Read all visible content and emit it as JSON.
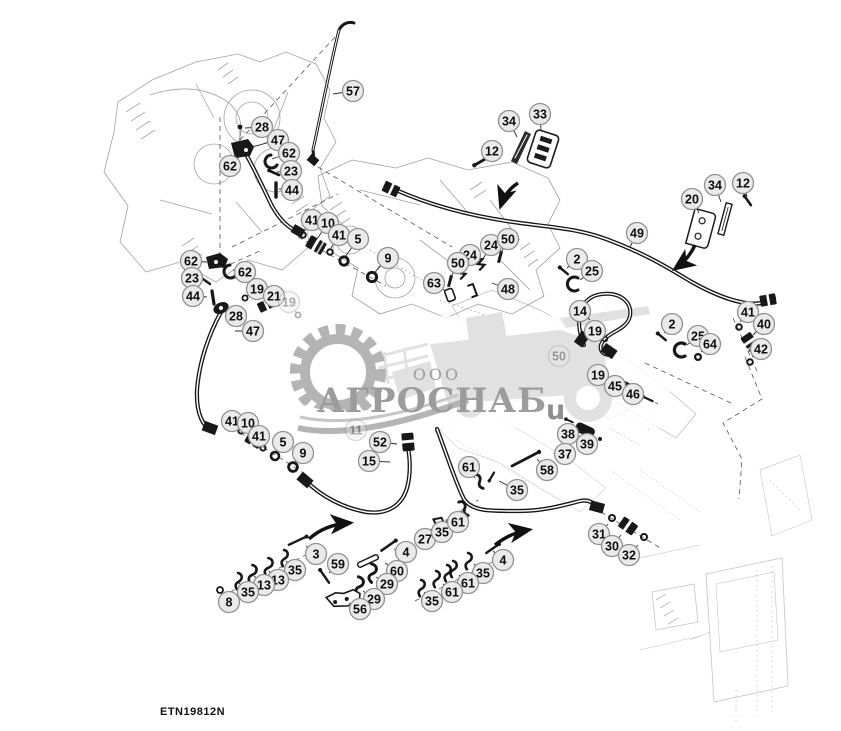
{
  "page": {
    "part_number": "ETN19812N"
  },
  "watermark": {
    "company_prefix": "ООО",
    "company": "АГРОСНАБ",
    "suffix": "u",
    "color": "#9c9c9c"
  },
  "callouts": {
    "style": {
      "radius": 10.5,
      "fill": "#eaeaea",
      "stroke": "#8f8f8f",
      "text_color": "#0d0d0d"
    },
    "labels": [
      {
        "n": "57",
        "x": 353,
        "y": 91,
        "tx": 333,
        "ty": 94
      },
      {
        "n": "28",
        "x": 262,
        "y": 127,
        "tx": 245,
        "ty": 128
      },
      {
        "n": "47",
        "x": 278,
        "y": 140,
        "tx": 252,
        "ty": 147
      },
      {
        "n": "62",
        "x": 289,
        "y": 153,
        "tx": 272,
        "ty": 159
      },
      {
        "n": "23",
        "x": 291,
        "y": 171,
        "tx": 277,
        "ty": 172
      },
      {
        "n": "44",
        "x": 292,
        "y": 190,
        "tx": 279,
        "ty": 189
      },
      {
        "n": "62",
        "x": 230,
        "y": 166,
        "tx": 240,
        "ty": 156
      },
      {
        "n": "12",
        "x": 492,
        "y": 151,
        "tx": 482,
        "ty": 160
      },
      {
        "n": "34",
        "x": 509,
        "y": 121,
        "tx": 517,
        "ty": 137
      },
      {
        "n": "33",
        "x": 540,
        "y": 114,
        "tx": 541,
        "ty": 130
      },
      {
        "n": "20",
        "x": 692,
        "y": 199,
        "tx": 699,
        "ty": 213
      },
      {
        "n": "34",
        "x": 715,
        "y": 185,
        "tx": 721,
        "ty": 202
      },
      {
        "n": "12",
        "x": 743,
        "y": 183,
        "tx": 747,
        "ty": 196
      },
      {
        "n": "49",
        "x": 637,
        "y": 233,
        "tx": 630,
        "ty": 247
      },
      {
        "n": "62",
        "x": 191,
        "y": 261,
        "tx": 207,
        "ty": 262
      },
      {
        "n": "23",
        "x": 192,
        "y": 278,
        "tx": 205,
        "ty": 280
      },
      {
        "n": "44",
        "x": 193,
        "y": 296,
        "tx": 207,
        "ty": 297
      },
      {
        "n": "62",
        "x": 245,
        "y": 272,
        "tx": 233,
        "ty": 270
      },
      {
        "n": "19",
        "x": 257,
        "y": 289,
        "tx": 247,
        "ty": 296
      },
      {
        "n": "21",
        "x": 274,
        "y": 296,
        "tx": 267,
        "ty": 302
      },
      {
        "n": "19",
        "x": 289,
        "y": 302,
        "tx": 296,
        "ty": 312,
        "faint": true
      },
      {
        "n": "28",
        "x": 236,
        "y": 316,
        "tx": 227,
        "ty": 311
      },
      {
        "n": "47",
        "x": 253,
        "y": 331,
        "tx": 235,
        "ty": 331
      },
      {
        "n": "41",
        "x": 312,
        "y": 220,
        "tx": 304,
        "ty": 231
      },
      {
        "n": "10",
        "x": 328,
        "y": 223,
        "tx": 317,
        "ty": 239
      },
      {
        "n": "41",
        "x": 339,
        "y": 235,
        "tx": 331,
        "ty": 248
      },
      {
        "n": "5",
        "x": 358,
        "y": 239,
        "tx": 345,
        "ty": 257
      },
      {
        "n": "9",
        "x": 388,
        "y": 258,
        "tx": 375,
        "ty": 272
      },
      {
        "n": "24",
        "x": 491,
        "y": 245,
        "tx": 483,
        "ty": 259
      },
      {
        "n": "50",
        "x": 508,
        "y": 239,
        "tx": 501,
        "ty": 253
      },
      {
        "n": "24",
        "x": 470,
        "y": 255,
        "tx": 463,
        "ty": 268
      },
      {
        "n": "50",
        "x": 458,
        "y": 263,
        "tx": 452,
        "ty": 275
      },
      {
        "n": "63",
        "x": 434,
        "y": 283,
        "tx": 445,
        "ty": 291
      },
      {
        "n": "48",
        "x": 508,
        "y": 289,
        "tx": 492,
        "ty": 283
      },
      {
        "n": "2",
        "x": 577,
        "y": 259,
        "tx": 567,
        "ty": 268
      },
      {
        "n": "25",
        "x": 592,
        "y": 271,
        "tx": 580,
        "ty": 280
      },
      {
        "n": "14",
        "x": 580,
        "y": 311,
        "tx": 590,
        "ty": 320
      },
      {
        "n": "19",
        "x": 595,
        "y": 331,
        "tx": 604,
        "ty": 338
      },
      {
        "n": "2",
        "x": 672,
        "y": 324,
        "tx": 664,
        "ty": 333
      },
      {
        "n": "25",
        "x": 698,
        "y": 336,
        "tx": 687,
        "ty": 345
      },
      {
        "n": "64",
        "x": 710,
        "y": 344,
        "tx": 701,
        "ty": 352
      },
      {
        "n": "41",
        "x": 748,
        "y": 312,
        "tx": 740,
        "ty": 322
      },
      {
        "n": "40",
        "x": 764,
        "y": 324,
        "tx": 753,
        "ty": 335
      },
      {
        "n": "42",
        "x": 761,
        "y": 349,
        "tx": 752,
        "ty": 357
      },
      {
        "n": "50",
        "x": 559,
        "y": 356,
        "tx": 567,
        "ty": 362,
        "faint": true
      },
      {
        "n": "19",
        "x": 598,
        "y": 375,
        "tx": 607,
        "ty": 379
      },
      {
        "n": "45",
        "x": 615,
        "y": 386,
        "tx": 623,
        "ty": 388
      },
      {
        "n": "46",
        "x": 633,
        "y": 394,
        "tx": 641,
        "ty": 397
      },
      {
        "n": "38",
        "x": 568,
        "y": 434,
        "tx": 577,
        "ty": 429
      },
      {
        "n": "39",
        "x": 587,
        "y": 444,
        "tx": 593,
        "ty": 438
      },
      {
        "n": "37",
        "x": 565,
        "y": 454,
        "tx": 574,
        "ty": 448
      },
      {
        "n": "41",
        "x": 232,
        "y": 421,
        "tx": 239,
        "ty": 429
      },
      {
        "n": "10",
        "x": 248,
        "y": 423,
        "tx": 252,
        "ty": 434
      },
      {
        "n": "41",
        "x": 259,
        "y": 436,
        "tx": 261,
        "ty": 444
      },
      {
        "n": "5",
        "x": 283,
        "y": 442,
        "tx": 276,
        "ty": 452
      },
      {
        "n": "9",
        "x": 303,
        "y": 453,
        "tx": 294,
        "ty": 463
      },
      {
        "n": "11",
        "x": 356,
        "y": 430,
        "tx": 364,
        "ty": 436,
        "faint": true
      },
      {
        "n": "52",
        "x": 380,
        "y": 442,
        "tx": 397,
        "ty": 444
      },
      {
        "n": "15",
        "x": 369,
        "y": 461,
        "tx": 390,
        "ty": 462
      },
      {
        "n": "61",
        "x": 469,
        "y": 467,
        "tx": 475,
        "ty": 478
      },
      {
        "n": "58",
        "x": 547,
        "y": 470,
        "tx": 537,
        "ty": 459
      },
      {
        "n": "35",
        "x": 517,
        "y": 490,
        "tx": 499,
        "ty": 481
      },
      {
        "n": "27",
        "x": 425,
        "y": 539,
        "tx": 436,
        "ty": 528
      },
      {
        "n": "35",
        "x": 442,
        "y": 532,
        "tx": 449,
        "ty": 520
      },
      {
        "n": "61",
        "x": 458,
        "y": 522,
        "tx": 462,
        "ty": 511
      },
      {
        "n": "4",
        "x": 406,
        "y": 552,
        "tx": 394,
        "ty": 549
      },
      {
        "n": "3",
        "x": 316,
        "y": 554,
        "tx": 306,
        "ty": 546
      },
      {
        "n": "35",
        "x": 295,
        "y": 570,
        "tx": 286,
        "ty": 561
      },
      {
        "n": "13",
        "x": 278,
        "y": 580,
        "tx": 269,
        "ty": 571
      },
      {
        "n": "13",
        "x": 264,
        "y": 585,
        "tx": 254,
        "ty": 576
      },
      {
        "n": "35",
        "x": 248,
        "y": 592,
        "tx": 239,
        "ty": 583
      },
      {
        "n": "8",
        "x": 229,
        "y": 602,
        "tx": 221,
        "ty": 593
      },
      {
        "n": "59",
        "x": 338,
        "y": 564,
        "tx": 329,
        "ty": 573
      },
      {
        "n": "60",
        "x": 397,
        "y": 571,
        "tx": 385,
        "ty": 563
      },
      {
        "n": "29",
        "x": 387,
        "y": 584,
        "tx": 376,
        "ty": 577
      },
      {
        "n": "29",
        "x": 374,
        "y": 599,
        "tx": 363,
        "ty": 591
      },
      {
        "n": "56",
        "x": 360,
        "y": 609,
        "tx": 349,
        "ty": 603
      },
      {
        "n": "4",
        "x": 503,
        "y": 560,
        "tx": 493,
        "ty": 551
      },
      {
        "n": "35",
        "x": 483,
        "y": 573,
        "tx": 474,
        "ty": 564
      },
      {
        "n": "61",
        "x": 468,
        "y": 583,
        "tx": 459,
        "ty": 575
      },
      {
        "n": "61",
        "x": 452,
        "y": 592,
        "tx": 443,
        "ty": 584
      },
      {
        "n": "35",
        "x": 432,
        "y": 601,
        "tx": 424,
        "ty": 592
      },
      {
        "n": "31",
        "x": 599,
        "y": 534,
        "tx": 608,
        "ty": 524
      },
      {
        "n": "30",
        "x": 612,
        "y": 546,
        "tx": 621,
        "ty": 535
      },
      {
        "n": "32",
        "x": 629,
        "y": 555,
        "tx": 638,
        "ty": 545
      }
    ]
  },
  "arrows": [
    {
      "d": "M518,183 C510,188 504,196 501,205"
    },
    {
      "d": "M695,245 C690,256 683,263 676,268"
    },
    {
      "d": "M309,539 C320,529 334,524 349,523"
    },
    {
      "d": "M495,545 C505,537 516,532 528,530"
    }
  ]
}
